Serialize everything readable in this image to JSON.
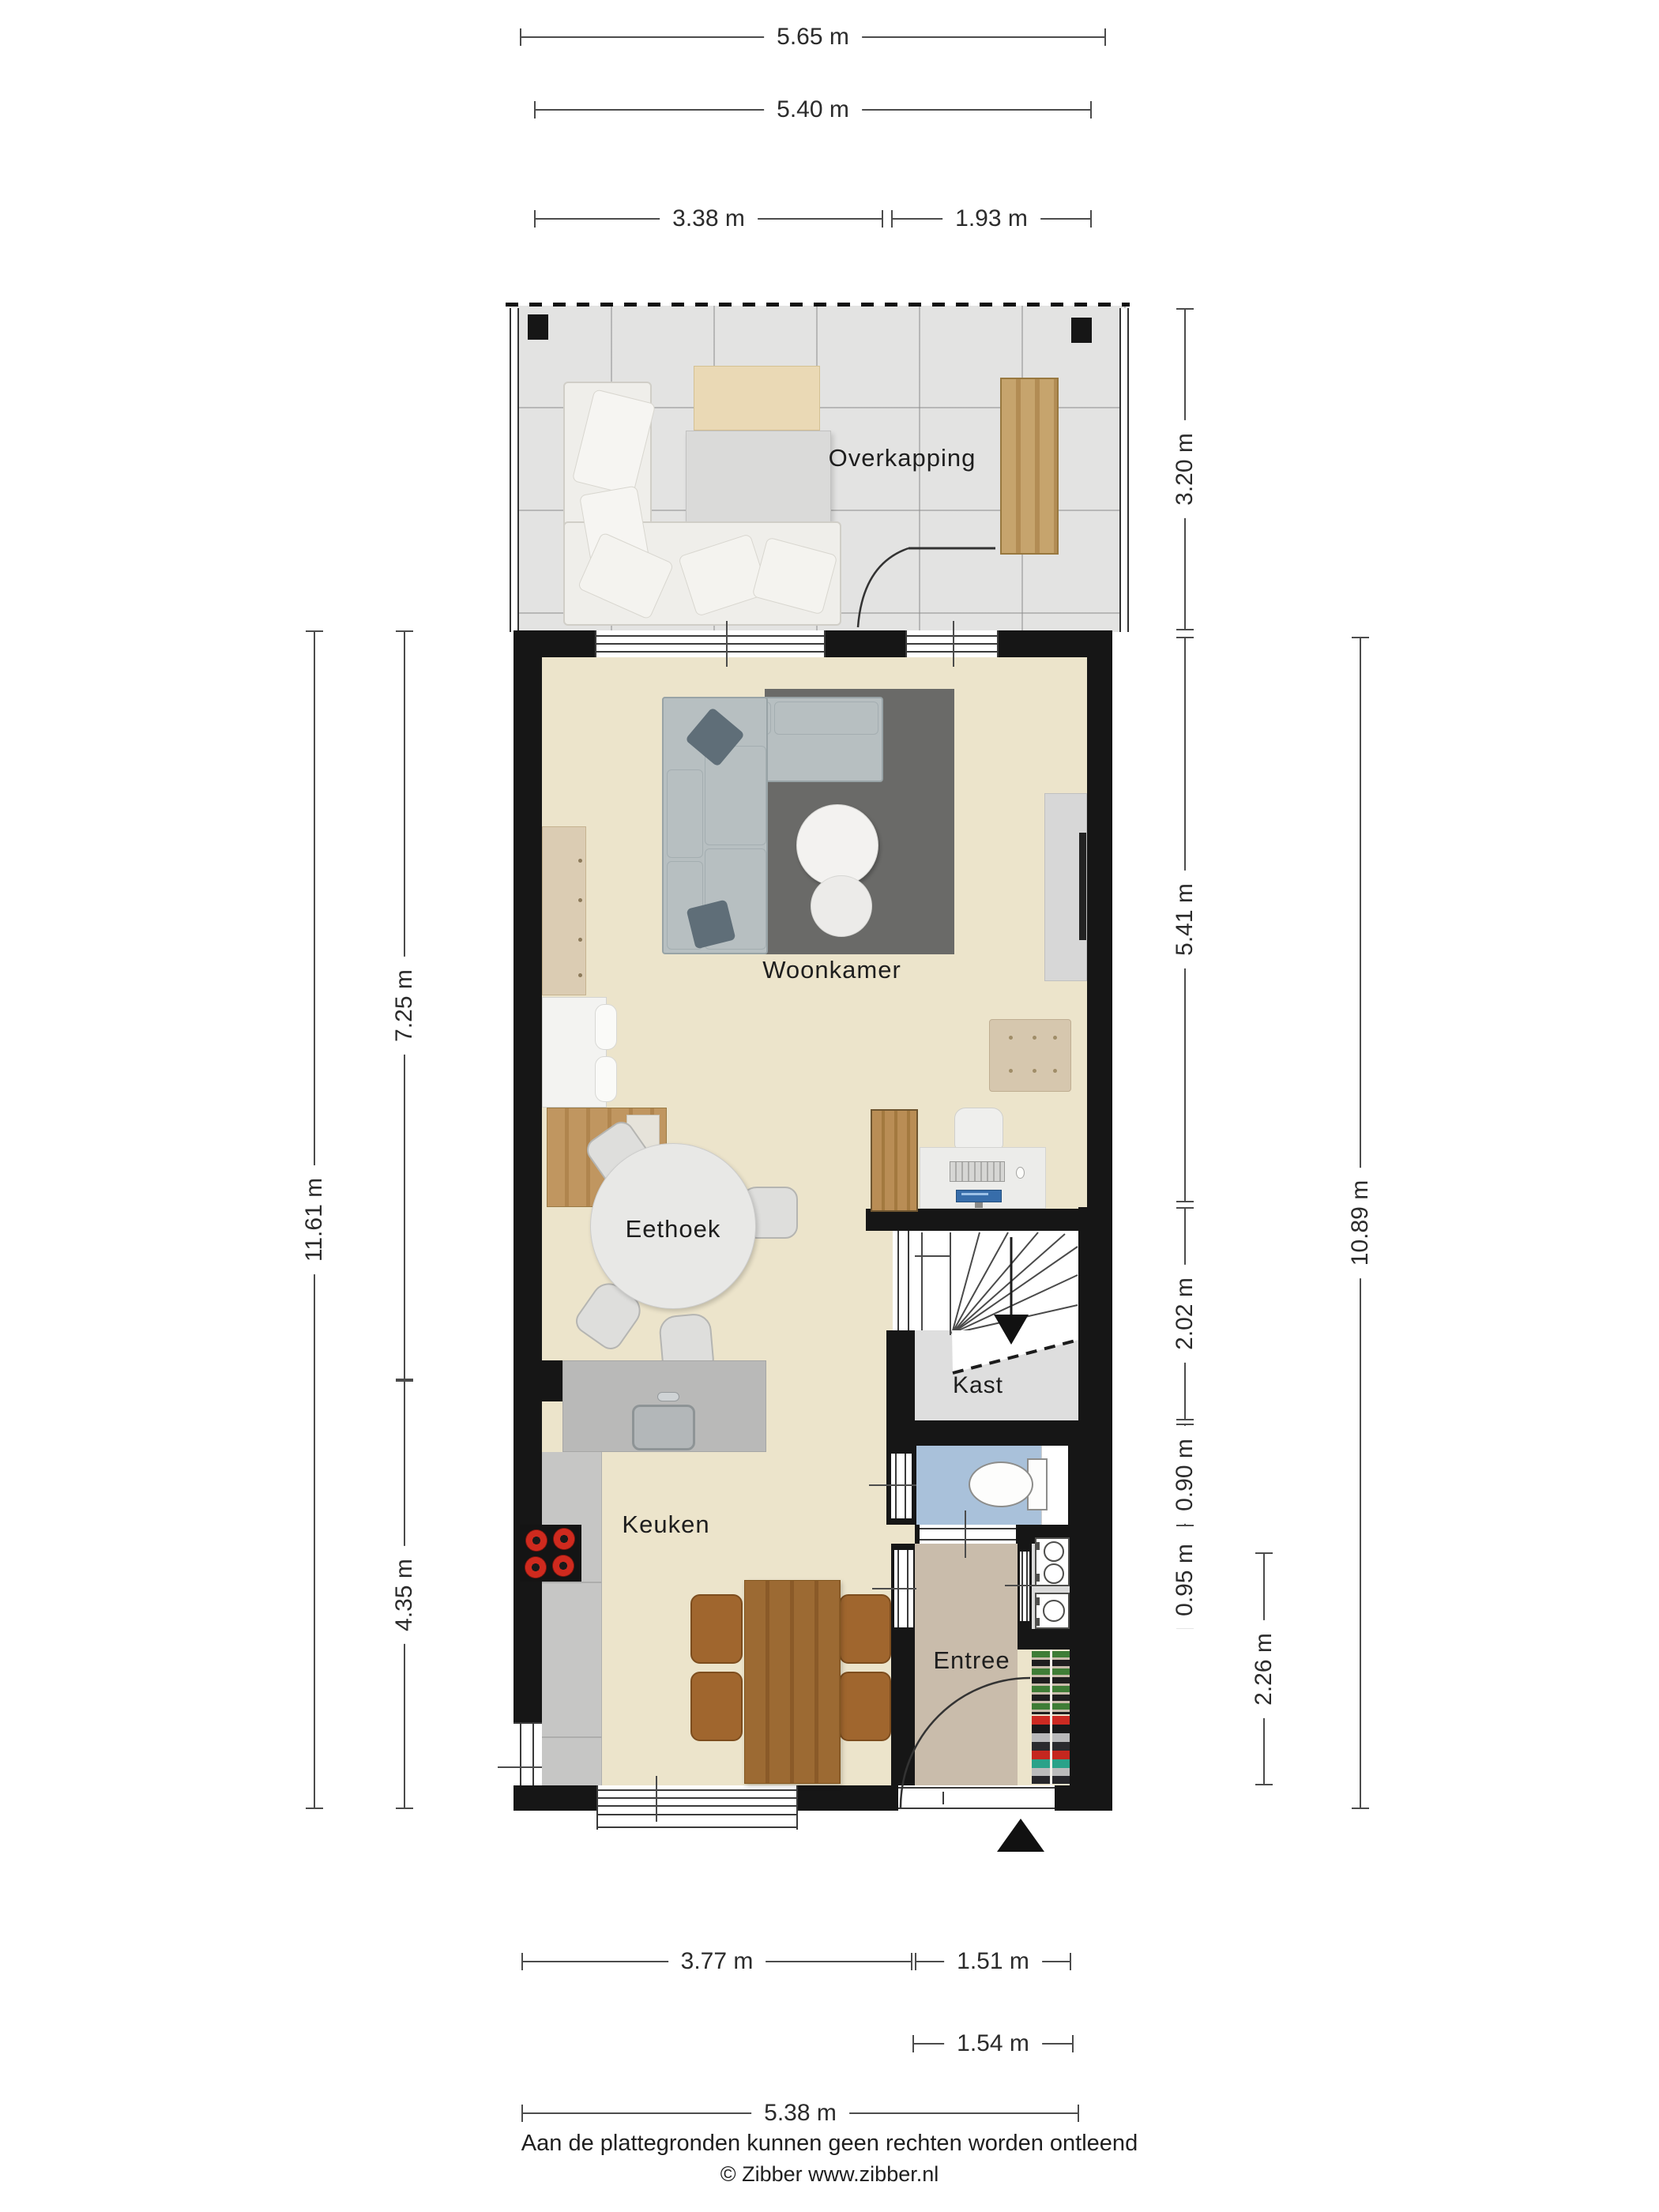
{
  "plan": {
    "rooms": {
      "overkapping": "Overkapping",
      "woonkamer": "Woonkamer",
      "eethoek": "Eethoek",
      "kast": "Kast",
      "keuken": "Keuken",
      "entree": "Entree"
    },
    "dimensions": {
      "top_total": "5.65 m",
      "top_inner": "5.40 m",
      "top_left": "3.38 m",
      "top_right": "1.93 m",
      "left_total": "11.61 m",
      "left_upper": "7.25 m",
      "left_lower": "4.35 m",
      "right_overkapping": "3.20 m",
      "right_woonkamer": "5.41 m",
      "right_stairs": "2.02 m",
      "right_toilet": "0.90 m",
      "right_washroom": "0.95 m",
      "right_entree": "2.26 m",
      "right_total": "10.89 m",
      "bottom_kitchen": "3.77 m",
      "bottom_door": "1.51 m",
      "bottom_entree": "1.54 m",
      "bottom_total": "5.38 m"
    },
    "footer": {
      "disclaimer": "Aan de plattegronden kunnen geen rechten worden ontleend",
      "credit": "© Zibber www.zibber.nl"
    }
  }
}
